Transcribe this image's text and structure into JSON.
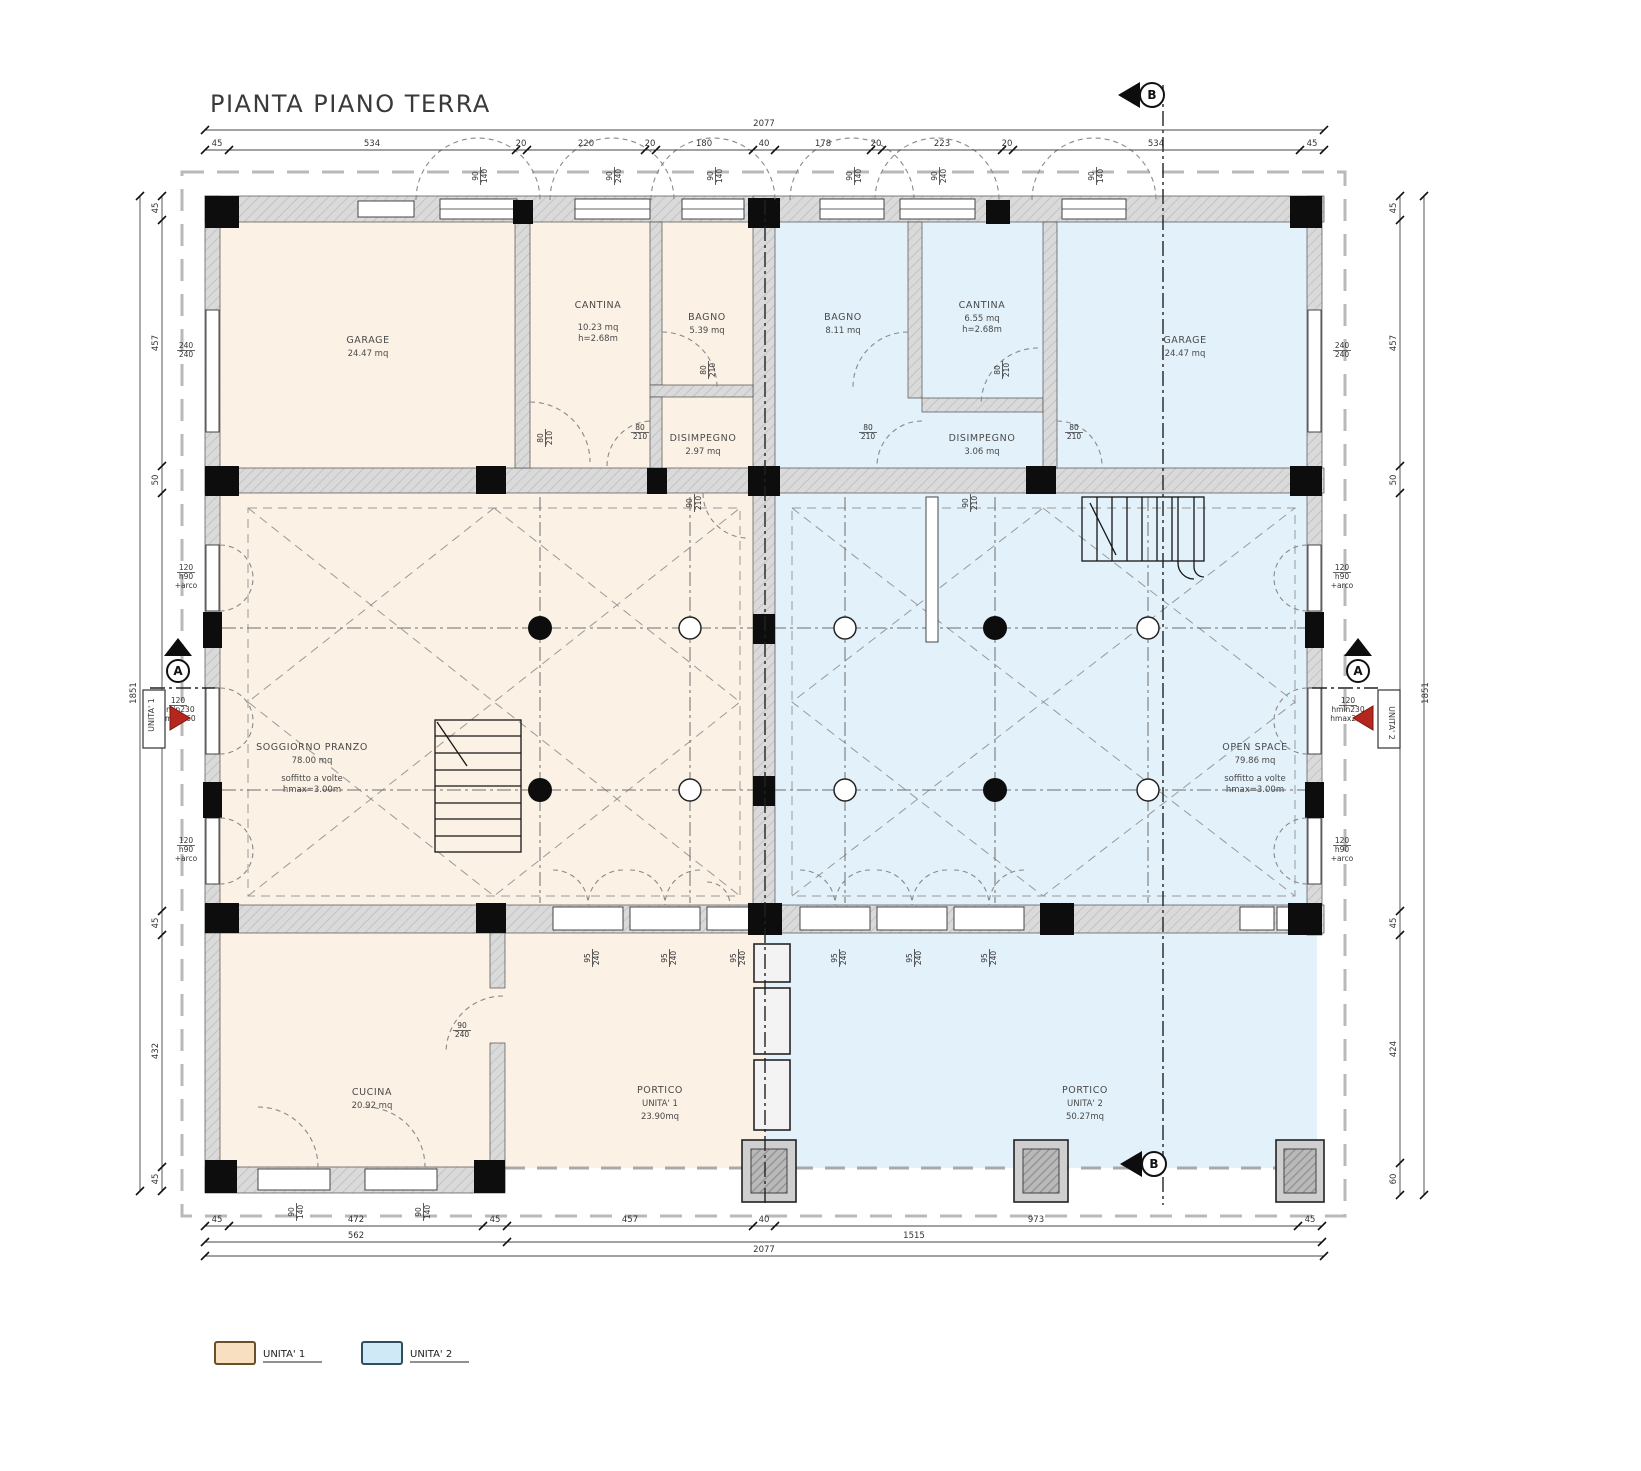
{
  "title": "PIANTA PIANO TERRA",
  "colors": {
    "unit1_fill": "#fbf1e5",
    "unit2_fill": "#e2f1fa",
    "arrow_red": "#b5271d"
  },
  "legend": {
    "unit1_label": "UNITA' 1",
    "unit2_label": "UNITA' 2"
  },
  "markers": {
    "section_a": "A",
    "section_b_top": "B",
    "section_b_bottom": "B",
    "unit1_tag": "UNITA' 1",
    "unit2_tag": "UNITA' 2"
  },
  "rooms": {
    "garage1": {
      "name": "GARAGE",
      "area": "24.47 mq"
    },
    "cantina1": {
      "name": "CANTINA",
      "area": "10.23 mq",
      "height": "h=2.68m"
    },
    "bagno1": {
      "name": "BAGNO",
      "area": "5.39 mq"
    },
    "disimpegno1": {
      "name": "DISIMPEGNO",
      "area": "2.97 mq"
    },
    "soggiorno": {
      "name": "SOGGIORNO PRANZO",
      "area": "78.00 mq",
      "note1": "soffitto a volte",
      "note2": "hmax=3.00m"
    },
    "cucina": {
      "name": "CUCINA",
      "area": "20.92 mq"
    },
    "portico1": {
      "name": "PORTICO",
      "unit": "UNITA' 1",
      "area": "23.90mq"
    },
    "bagno2": {
      "name": "BAGNO",
      "area": "8.11 mq"
    },
    "cantina2": {
      "name": "CANTINA",
      "area": "6.55 mq",
      "height": "h=2.68m"
    },
    "disimpegno2": {
      "name": "DISIMPEGNO",
      "area": "3.06 mq"
    },
    "garage2": {
      "name": "GARAGE",
      "area": "24.47 mq"
    },
    "openspace": {
      "name": "OPEN SPACE",
      "area": "79.86 mq",
      "note1": "soffitto a volte",
      "note2": "hmax=3.00m"
    },
    "portico2": {
      "name": "PORTICO",
      "unit": "UNITA' 2",
      "area": "50.27mq"
    }
  },
  "dimensions": {
    "top_total": "2077",
    "top_segments": [
      "45",
      "534",
      "20",
      "220",
      "20",
      "180",
      "40",
      "178",
      "20",
      "223",
      "20",
      "534",
      "45"
    ],
    "bottom_segments": [
      "45",
      "472",
      "45",
      "457",
      "40",
      "973",
      "45"
    ],
    "bottom_subtotals": [
      "562",
      "1515"
    ],
    "bottom_total": "2077",
    "left_segments": [
      "45",
      "457",
      "50",
      "777",
      "45",
      "432",
      "45"
    ],
    "left_total": "1851",
    "right_segments": [
      "45",
      "457",
      "50",
      "777",
      "45",
      "424",
      "60"
    ],
    "right_total": "1851"
  },
  "openings": {
    "tags": [
      [
        "90",
        "140"
      ],
      [
        "90",
        "240"
      ],
      [
        "90",
        "140"
      ],
      [
        "90",
        "140"
      ],
      [
        "90",
        "240"
      ],
      [
        "90",
        "140"
      ],
      [
        "240",
        "240"
      ],
      [
        "120",
        "h90",
        "+arco"
      ],
      [
        "120",
        "hmin230",
        "hmax260"
      ],
      [
        "120",
        "h90",
        "+arco"
      ],
      [
        "240",
        "240"
      ],
      [
        "120",
        "h90",
        "+arco"
      ],
      [
        "120",
        "hmin230",
        "hmax260"
      ],
      [
        "120",
        "h90",
        "+arco"
      ],
      [
        "80",
        "210"
      ],
      [
        "80",
        "210"
      ],
      [
        "80",
        "210"
      ],
      [
        "80",
        "210"
      ],
      [
        "80",
        "210"
      ],
      [
        "80",
        "210"
      ],
      [
        "90",
        "210"
      ],
      [
        "90",
        "210"
      ],
      [
        "90",
        "240"
      ],
      [
        "95",
        "240"
      ],
      [
        "95",
        "240"
      ],
      [
        "95",
        "240"
      ],
      [
        "95",
        "240"
      ],
      [
        "95",
        "240"
      ],
      [
        "95",
        "240"
      ],
      [
        "90",
        "140"
      ],
      [
        "90",
        "140"
      ]
    ]
  }
}
